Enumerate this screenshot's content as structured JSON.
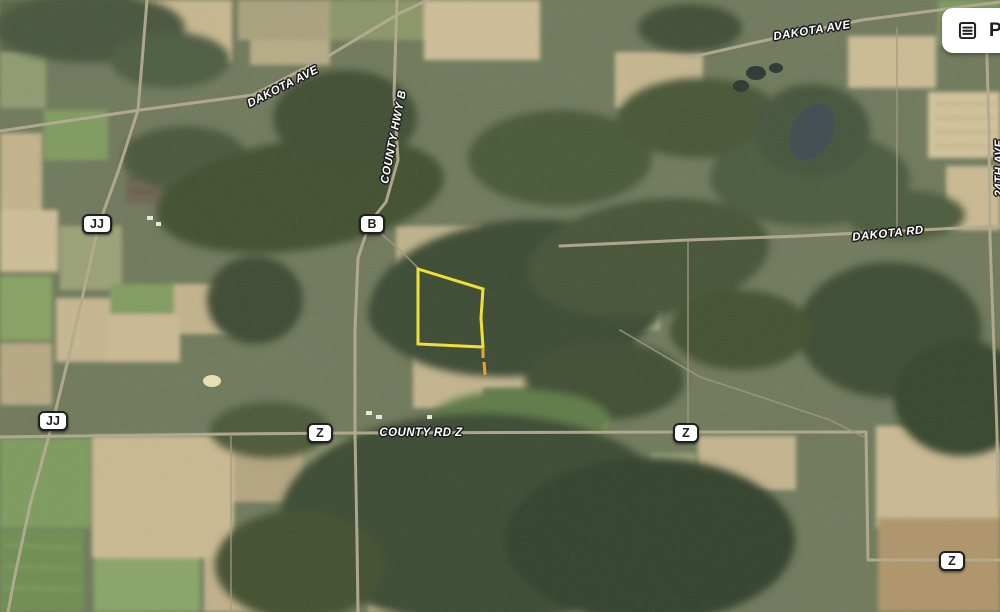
{
  "map": {
    "view": "satellite",
    "road_labels": [
      {
        "text": "DAKOTA AVE",
        "x": 283,
        "y": 87,
        "rotation": -27
      },
      {
        "text": "COUNTY HWY B",
        "x": 394,
        "y": 137,
        "rotation": -79
      },
      {
        "text": "DAKOTA AVE",
        "x": 812,
        "y": 31,
        "rotation": -9
      },
      {
        "text": "DAKOTA RD",
        "x": 888,
        "y": 234,
        "rotation": -6
      },
      {
        "text": "COUNTY RD Z",
        "x": 421,
        "y": 433,
        "rotation": 0
      },
      {
        "text": "24TH AVE",
        "x": 1000,
        "y": 168,
        "rotation": -90
      }
    ],
    "route_badges": [
      {
        "text": "JJ",
        "x": 97,
        "y": 224
      },
      {
        "text": "B",
        "x": 372,
        "y": 224
      },
      {
        "text": "JJ",
        "x": 53,
        "y": 421
      },
      {
        "text": "Z",
        "x": 320,
        "y": 433
      },
      {
        "text": "Z",
        "x": 686,
        "y": 433
      },
      {
        "text": "Z",
        "x": 952,
        "y": 561
      }
    ],
    "parcel": {
      "stroke": "#F2DF35",
      "stroke_width": 3,
      "points": [
        [
          418,
          269
        ],
        [
          483,
          289
        ],
        [
          481,
          318
        ],
        [
          483,
          347
        ],
        [
          418,
          344
        ]
      ],
      "tail": {
        "stroke": "#E8A23B",
        "segments": [
          [
            [
              483,
              349
            ],
            [
              483,
              358
            ]
          ],
          [
            [
              484,
              362
            ],
            [
              485,
              375
            ]
          ]
        ]
      }
    },
    "roads": [
      {
        "name": "dakota-ave-west",
        "major": true,
        "points": [
          [
            0,
            131
          ],
          [
            140,
            110
          ],
          [
            253,
            95
          ],
          [
            330,
            55
          ],
          [
            400,
            13
          ],
          [
            428,
            0
          ]
        ]
      },
      {
        "name": "county-hwy-b",
        "major": true,
        "points": [
          [
            397,
            0
          ],
          [
            394,
            95
          ],
          [
            398,
            160
          ],
          [
            386,
            202
          ],
          [
            370,
            222
          ],
          [
            358,
            258
          ],
          [
            355,
            330
          ],
          [
            355,
            433
          ],
          [
            357,
            540
          ],
          [
            358,
            612
          ]
        ]
      },
      {
        "name": "county-rd-jj",
        "major": true,
        "points": [
          [
            147,
            0
          ],
          [
            142,
            62
          ],
          [
            138,
            110
          ],
          [
            118,
            172
          ],
          [
            99,
            224
          ],
          [
            84,
            290
          ],
          [
            68,
            360
          ],
          [
            53,
            421
          ],
          [
            30,
            505
          ],
          [
            14,
            580
          ],
          [
            8,
            612
          ]
        ]
      },
      {
        "name": "dakota-ave-east",
        "major": true,
        "points": [
          [
            688,
            58
          ],
          [
            780,
            37
          ],
          [
            862,
            20
          ],
          [
            1000,
            2
          ]
        ]
      },
      {
        "name": "dakota-rd",
        "major": true,
        "points": [
          [
            560,
            246
          ],
          [
            688,
            240
          ],
          [
            800,
            236
          ],
          [
            1000,
            226
          ]
        ]
      },
      {
        "name": "county-rd-z",
        "major": true,
        "points": [
          [
            0,
            437
          ],
          [
            230,
            434
          ],
          [
            355,
            433
          ],
          [
            686,
            432
          ],
          [
            866,
            432
          ],
          [
            868,
            560
          ],
          [
            1000,
            560
          ]
        ]
      },
      {
        "name": "24th-ave",
        "major": true,
        "points": [
          [
            986,
            22
          ],
          [
            989,
            130
          ],
          [
            990,
            237
          ],
          [
            994,
            350
          ],
          [
            997,
            433
          ],
          [
            998,
            505
          ]
        ]
      },
      {
        "name": "local-road",
        "major": false,
        "points": [
          [
            897,
            28
          ],
          [
            897,
            237
          ]
        ]
      },
      {
        "name": "local-road",
        "major": false,
        "points": [
          [
            688,
            240
          ],
          [
            688,
            432
          ]
        ]
      },
      {
        "name": "local-road",
        "major": false,
        "points": [
          [
            231,
            434
          ],
          [
            231,
            612
          ]
        ]
      },
      {
        "name": "driveway",
        "major": false,
        "points": [
          [
            372,
            226
          ],
          [
            400,
            250
          ],
          [
            418,
            268
          ]
        ]
      },
      {
        "name": "local-road",
        "major": false,
        "points": [
          [
            620,
            330
          ],
          [
            700,
            377
          ],
          [
            770,
            400
          ],
          [
            830,
            420
          ],
          [
            866,
            438
          ]
        ]
      }
    ]
  },
  "controls": {
    "report_button": {
      "label": "P",
      "icon": "document-list-icon"
    }
  }
}
